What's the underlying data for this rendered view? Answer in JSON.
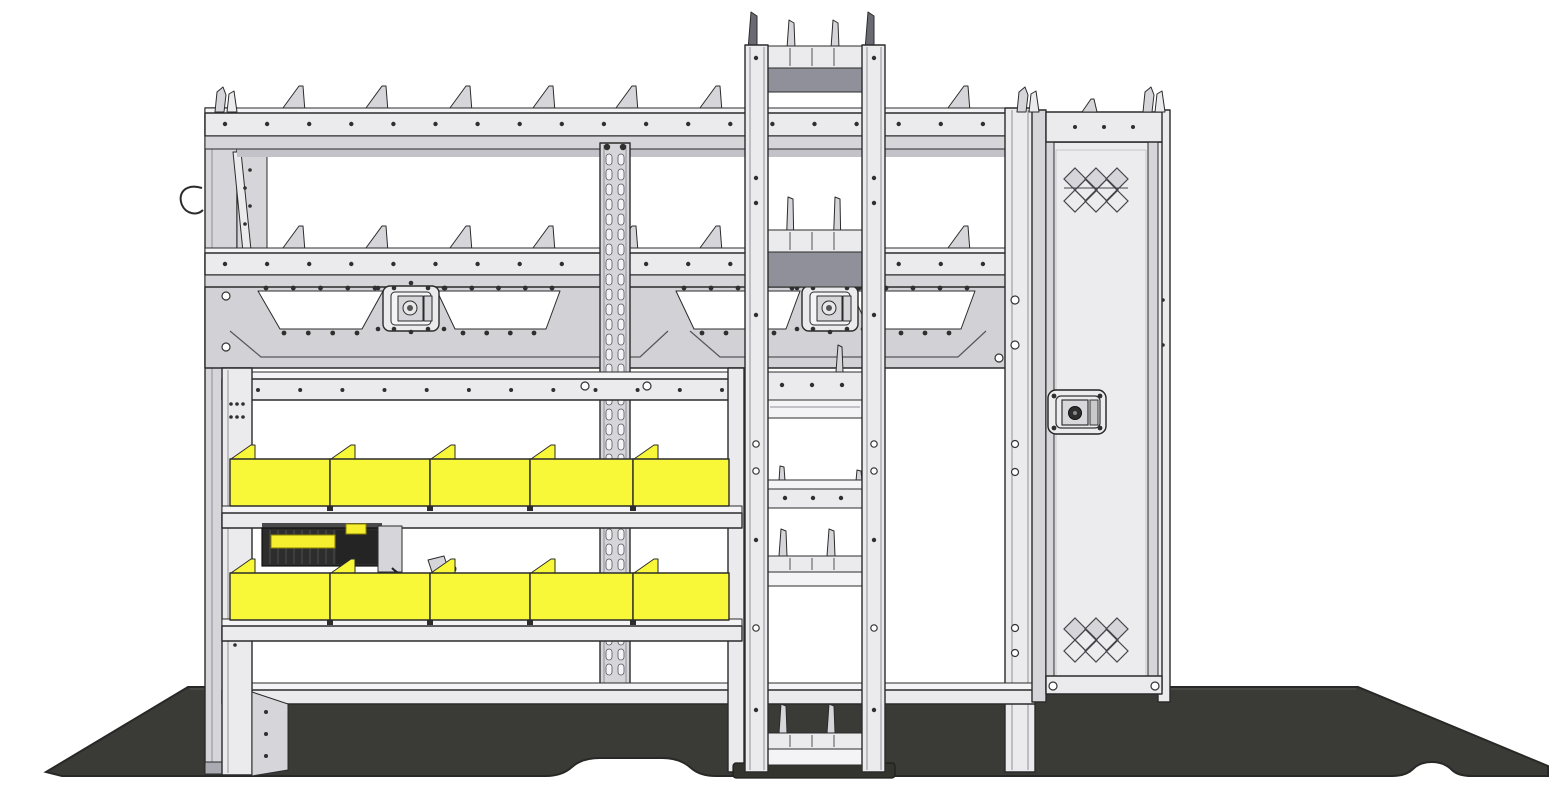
{
  "scene": {
    "type": "technical-illustration",
    "subject": "Van shelving package side elevation with parts bins, ladder rack, locker cabinet and floor mat",
    "background_color": "#ffffff"
  },
  "colors": {
    "outline": "#2b2b2b",
    "structure_light": "#ebebee",
    "structure_lighter": "#f4f4f6",
    "structure_mid": "#d6d6da",
    "structure_dark": "#aaaab2",
    "tray_shadow": "#90909a",
    "bin_yellow": "#f9f838",
    "floor_mat": "#3a3a37",
    "floor_edge": "#282826",
    "charger_body": "#2d2d2d",
    "charger_accent": "#f6ef2f",
    "rivet": "#2f2f2f",
    "window_white": "#ffffff"
  },
  "components": {
    "shelving_unit": {
      "shelf_count": 3,
      "divider_fins_per_shelf": 7
    },
    "bin_rows": [
      {
        "bin_count": 5
      },
      {
        "bin_count": 5
      }
    ],
    "louvered_panel": {
      "window_count": 4,
      "latch_count": 2
    },
    "slotted_strut": {
      "slot_columns": 2,
      "slot_rows": 35
    },
    "ladder_rack": {
      "tray_count": 6
    },
    "locker": {
      "vent_count": 2,
      "diamonds_per_vent": 8,
      "lock_count": 1
    },
    "charger_station": {
      "accent_count": 2
    },
    "floor_mat": {
      "present": true
    }
  }
}
